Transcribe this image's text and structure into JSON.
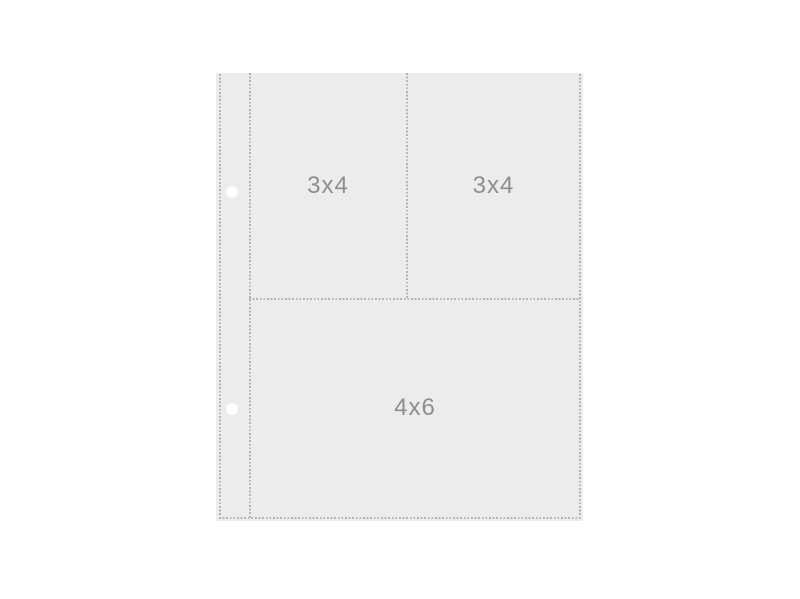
{
  "sheet": {
    "pockets": [
      {
        "position": "top-left",
        "label": "3x4"
      },
      {
        "position": "top-right",
        "label": "3x4"
      },
      {
        "position": "bottom",
        "label": "4x6"
      }
    ],
    "binder_holes_count": 2,
    "colors": {
      "canvas_background": "#ffffff",
      "sheet_fill": "#ececec",
      "stitch": "#b3b3b3",
      "label_text": "#8e8e8e",
      "hole_fill": "#ffffff"
    }
  }
}
